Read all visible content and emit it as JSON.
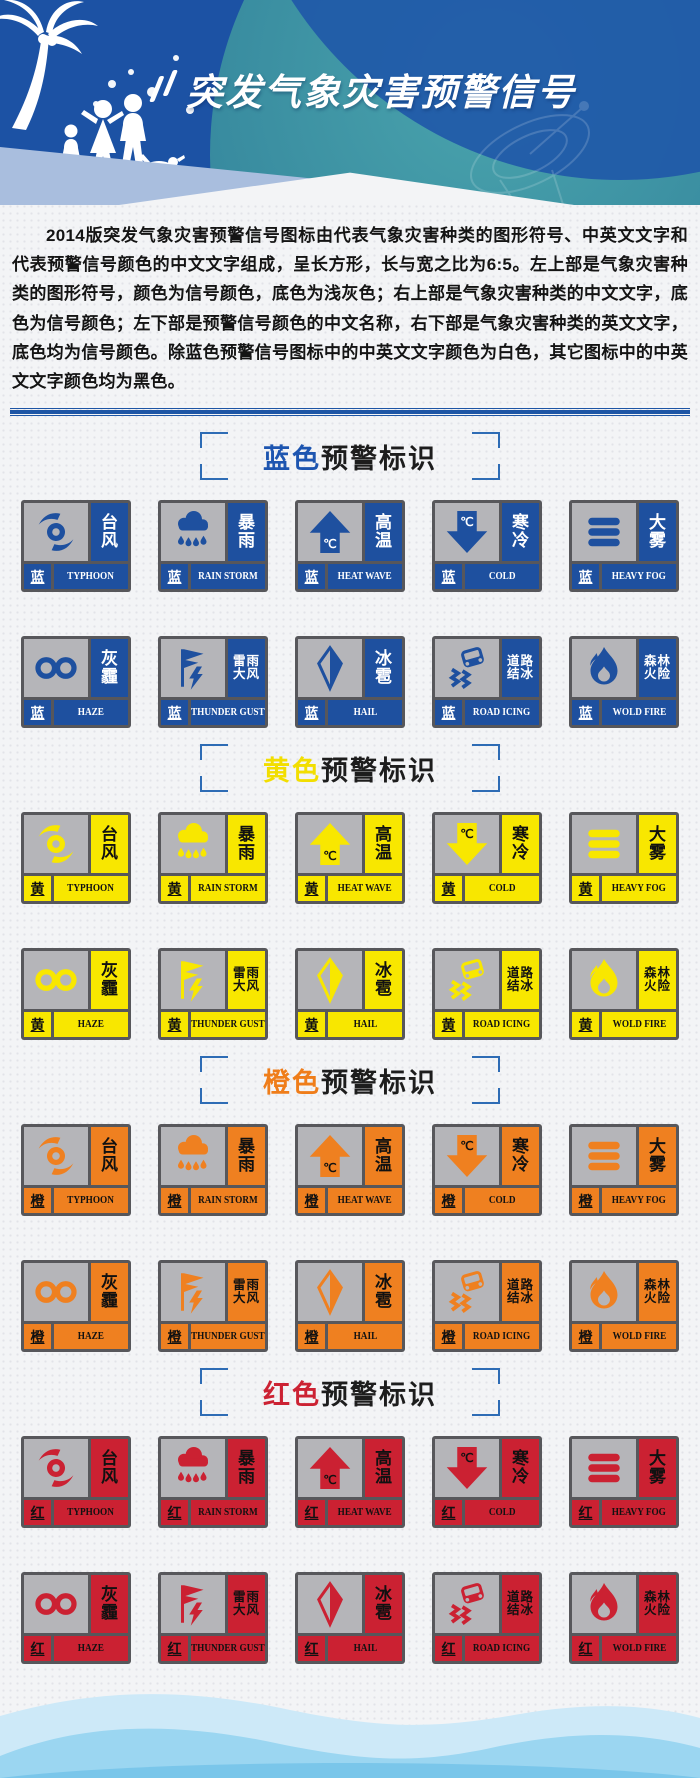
{
  "header": {
    "title": "突发气象灾害预警信号",
    "title_color": "#ffffff"
  },
  "intro": {
    "text": "2014版突发气象灾害预警信号图标由代表气象灾害种类的图形符号、中英文文字和代表预警信号颜色的中文文字组成，呈长方形，长与宽之比为6:5。左上部是气象灾害种类的图形符号，颜色为信号颜色，底色为浅灰色；右上部是气象灾害种类的中文文字，底色为信号颜色；左下部是预警信号颜色的中文名称，右下部是气象灾害种类的英文文字，底色均为信号颜色。除蓝色预警信号图标中的中英文文字颜色为白色，其它图标中的中英文文字颜色均为黑色。"
  },
  "sections": [
    {
      "id": "blue",
      "title_color_word": "蓝色",
      "title_rest": "预警标识",
      "badge": "蓝",
      "color": "#1e509f",
      "text_color": "#ffffff",
      "title_word_color": "#1d55b0"
    },
    {
      "id": "yellow",
      "title_color_word": "黄色",
      "title_rest": "预警标识",
      "badge": "黄",
      "color": "#f8e700",
      "text_color": "#111111",
      "title_word_color": "#f2de00"
    },
    {
      "id": "orange",
      "title_color_word": "橙色",
      "title_rest": "预警标识",
      "badge": "橙",
      "color": "#ef8020",
      "text_color": "#111111",
      "title_word_color": "#ef7d1a"
    },
    {
      "id": "red",
      "title_color_word": "红色",
      "title_rest": "预警标识",
      "badge": "红",
      "color": "#cb2132",
      "text_color": "#111111",
      "title_word_color": "#cc2233"
    }
  ],
  "signal_types": [
    {
      "id": "typhoon",
      "zh": "台风",
      "zh_lines": [
        "台",
        "风"
      ],
      "en": "TYPHOON",
      "icon": "typhoon-icon"
    },
    {
      "id": "rainstorm",
      "zh": "暴雨",
      "zh_lines": [
        "暴",
        "雨"
      ],
      "en": "RAIN STORM",
      "icon": "rainstorm-icon"
    },
    {
      "id": "heatwave",
      "zh": "高温",
      "zh_lines": [
        "高",
        "温"
      ],
      "en": "HEAT WAVE",
      "icon": "heatwave-icon"
    },
    {
      "id": "cold",
      "zh": "寒冷",
      "zh_lines": [
        "寒",
        "冷"
      ],
      "en": "COLD",
      "icon": "cold-icon"
    },
    {
      "id": "heavyfog",
      "zh": "大雾",
      "zh_lines": [
        "大",
        "雾"
      ],
      "en": "HEAVY FOG",
      "icon": "heavyfog-icon"
    },
    {
      "id": "haze",
      "zh": "灰霾",
      "zh_lines": [
        "灰",
        "霾"
      ],
      "en": "HAZE",
      "icon": "haze-icon"
    },
    {
      "id": "thundergust",
      "zh": "雷雨大风",
      "zh_lines": [
        "雷雨",
        "大风"
      ],
      "en": "THUNDER GUST",
      "icon": "thundergust-icon"
    },
    {
      "id": "hail",
      "zh": "冰雹",
      "zh_lines": [
        "冰",
        "雹"
      ],
      "en": "HAIL",
      "icon": "hail-icon"
    },
    {
      "id": "roadicing",
      "zh": "道路结冰",
      "zh_lines": [
        "道路",
        "结冰"
      ],
      "en": "ROAD ICING",
      "icon": "roadicing-icon"
    },
    {
      "id": "wildfire",
      "zh": "森林火险",
      "zh_lines": [
        "森林",
        "火险"
      ],
      "en": "WOLD FIRE",
      "icon": "wildfire-icon"
    }
  ],
  "palette": {
    "header_blue": "#1c52a4",
    "header_teal": "#34859c",
    "periwinkle": "#a9bede",
    "rule_blue": "#1d55a5",
    "bracket_blue": "#2e6cb5",
    "card_border": "#57575b",
    "icon_bg": "#b5b5b9",
    "page_bg": "#f3f4f6",
    "wave_light": "#cde9f8",
    "wave_mid": "#9bd6f1",
    "wave_deep": "#7ac6ea"
  }
}
